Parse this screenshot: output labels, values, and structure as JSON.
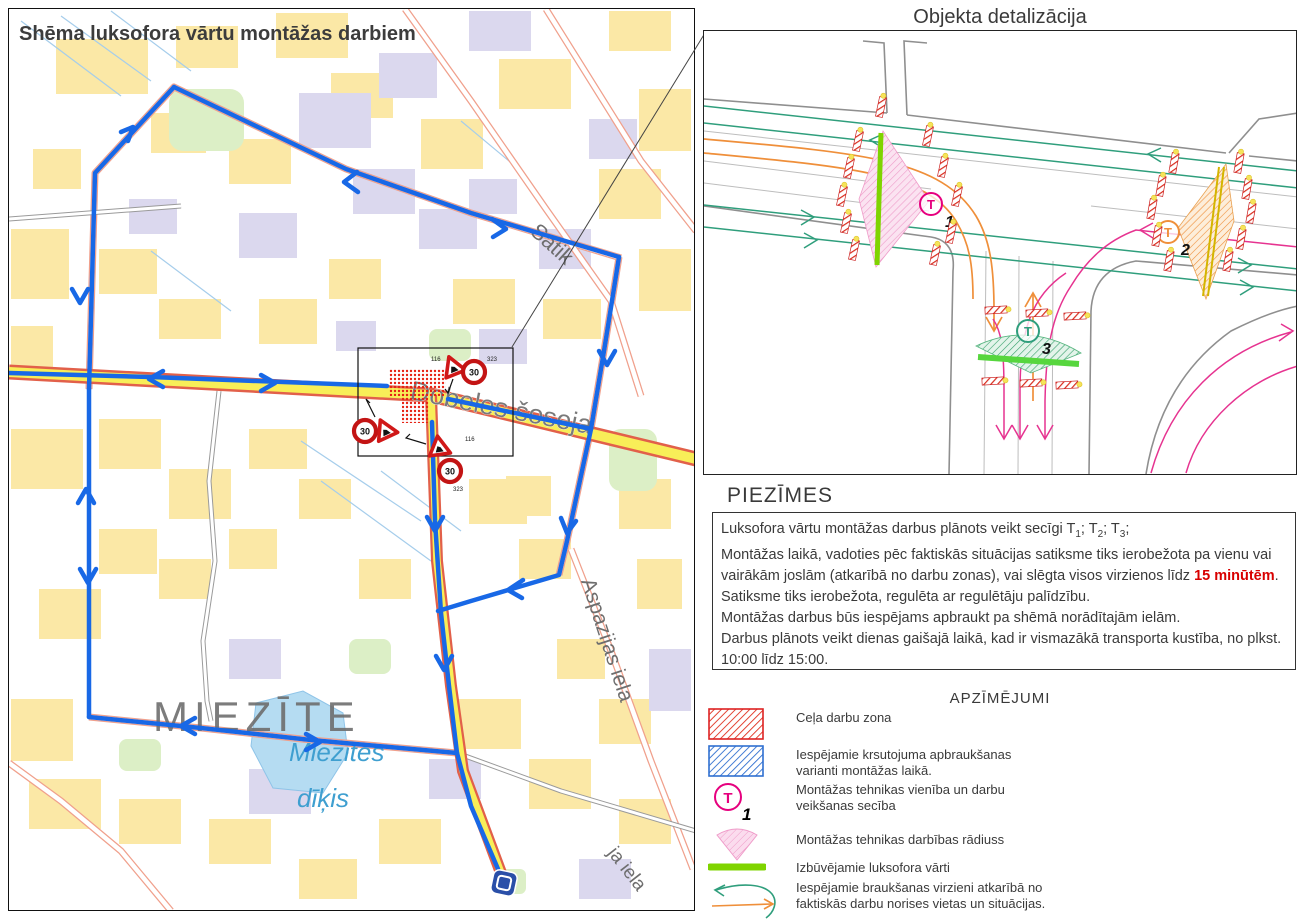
{
  "map": {
    "title": "Shēma luksofora vārtu montāžas darbiem",
    "district_label": "MIEZĪTE",
    "pond_label_line1": "Miezītes",
    "pond_label_line2": "dīķis",
    "street_dobeles": "Dobeles šoseja",
    "street_satiksmes": "Satik",
    "street_aspazijas": "Aspazijas iela",
    "street_partial": "ja iela",
    "speed_sign": "30",
    "sign_code_roadworks": "116",
    "sign_code_speed": "323"
  },
  "detail": {
    "title": "Objekta detalizācija",
    "unit_letter": "T",
    "units": [
      {
        "number": "1"
      },
      {
        "number": "2"
      },
      {
        "number": "3"
      }
    ]
  },
  "notes": {
    "heading": "PIEZĪMES",
    "l1a": "Luksofora vārtu montāžas darbus plānots veikt secīgi T",
    "t1": "1",
    "l1b": "; T",
    "t2": "2",
    "l1c": "; T",
    "t3": "3",
    "l1d": ";",
    "l2": "Montāžas laikā, vadoties pēc faktiskās situācijas satiksme tiks ierobežota pa vienu vai vairākām joslām (atkarībā no darbu zonas), vai slēgta visos virzienos līdz ",
    "l2_highlight": "15 minūtēm",
    "l2_end": ".",
    "l3": "Satiksme tiks ierobežota, regulēta ar regulētāju palīdzību.",
    "l4": "Montāžas darbus būs iespējams apbraukt pa shēmā norādītajām ielām.",
    "l5": "Darbus plānots veikt dienas gaišajā laikā, kad ir vismazākā transporta kustība, no plkst. 10:00 līdz 15:00."
  },
  "legend": {
    "heading": "APZĪMĒJUMI",
    "unit_letter": "T",
    "unit_number": "1",
    "items": [
      {
        "label1": "Ceļa darbu zona",
        "label2": ""
      },
      {
        "label1": "Iespējamie krsutojuma apbraukšanas",
        "label2": "varianti montāžas laikā."
      },
      {
        "label1": "Montāžas tehnikas vienība un darbu",
        "label2": "veikšanas secība"
      },
      {
        "label1": "Montāžas tehnikas darbības rādiuss",
        "label2": ""
      },
      {
        "label1": "Izbūvējamie luksofora vārti",
        "label2": ""
      },
      {
        "label1": "Iespējamie braukšanas virzieni atkarībā no",
        "label2": "faktiskās darbu norises vietas un situācijas."
      }
    ]
  },
  "colors": {
    "route_blue": "#1868e6",
    "work_zone_red": "#e62012",
    "gate_green": "#7fd400",
    "direction_teal": "#2f9e7c",
    "direction_orange": "#ef8f3a",
    "direction_magenta": "#e63390",
    "highlight_red": "#d80000"
  }
}
